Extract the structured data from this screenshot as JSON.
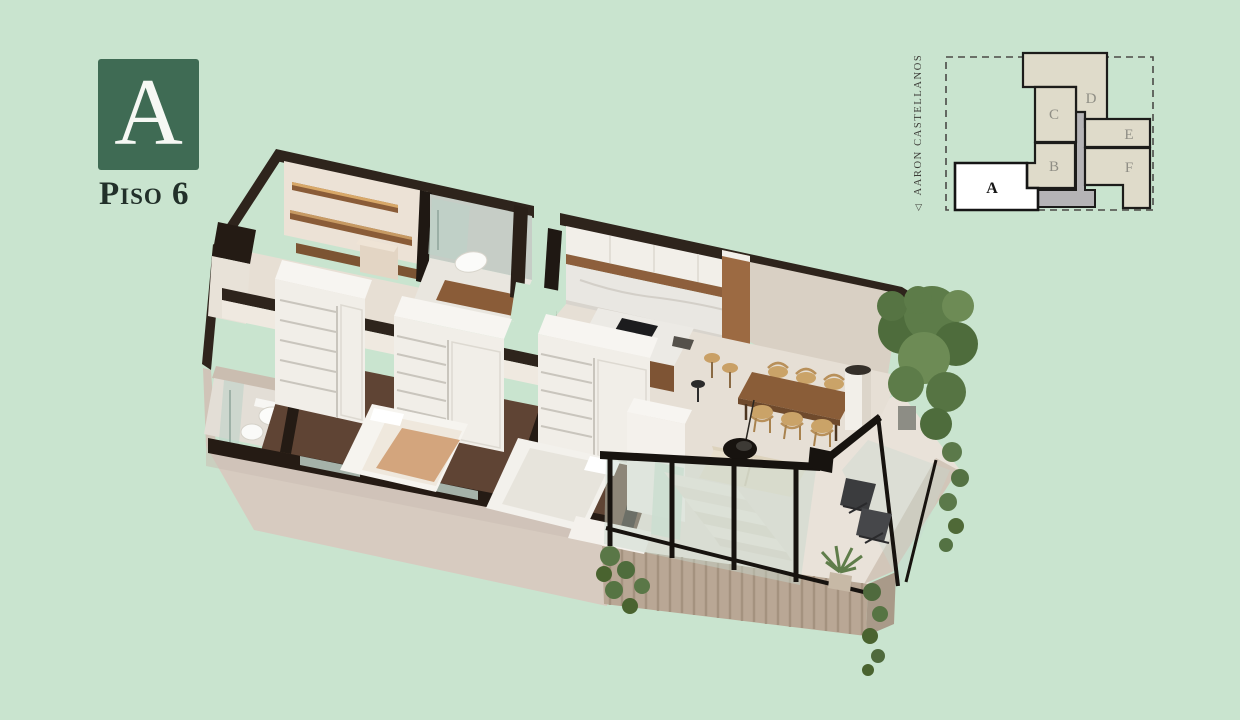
{
  "palette": {
    "background": "#c9e4cf",
    "badge_green": "#3f6b54",
    "dark_text": "#22302a",
    "keyplan_unit_fill": "#dfdbca",
    "keyplan_core_fill": "#b5b4b6",
    "keyplan_highlight_fill": "#ffffff",
    "keyplan_outline": "#1c1c1a",
    "wall_dark": "#2e241c",
    "wall_cream": "#d9d0c4",
    "floor_wood": "#5f4434",
    "floor_light": "#e6dfd5",
    "wood_furniture": "#96663f",
    "plant_green": "#5d7c49",
    "frame_black": "#17130f"
  },
  "unit_badge": {
    "letter": "A",
    "floor_label": "Piso 6"
  },
  "keyplan": {
    "street": {
      "marker": "◁",
      "name": "AARON CASTELLANOS"
    },
    "highlighted_unit": "A",
    "units": [
      {
        "label": "A",
        "highlighted": true
      },
      {
        "label": "B",
        "highlighted": false
      },
      {
        "label": "C",
        "highlighted": false
      },
      {
        "label": "D",
        "highlighted": false
      },
      {
        "label": "E",
        "highlighted": false
      },
      {
        "label": "F",
        "highlighted": false
      }
    ]
  }
}
